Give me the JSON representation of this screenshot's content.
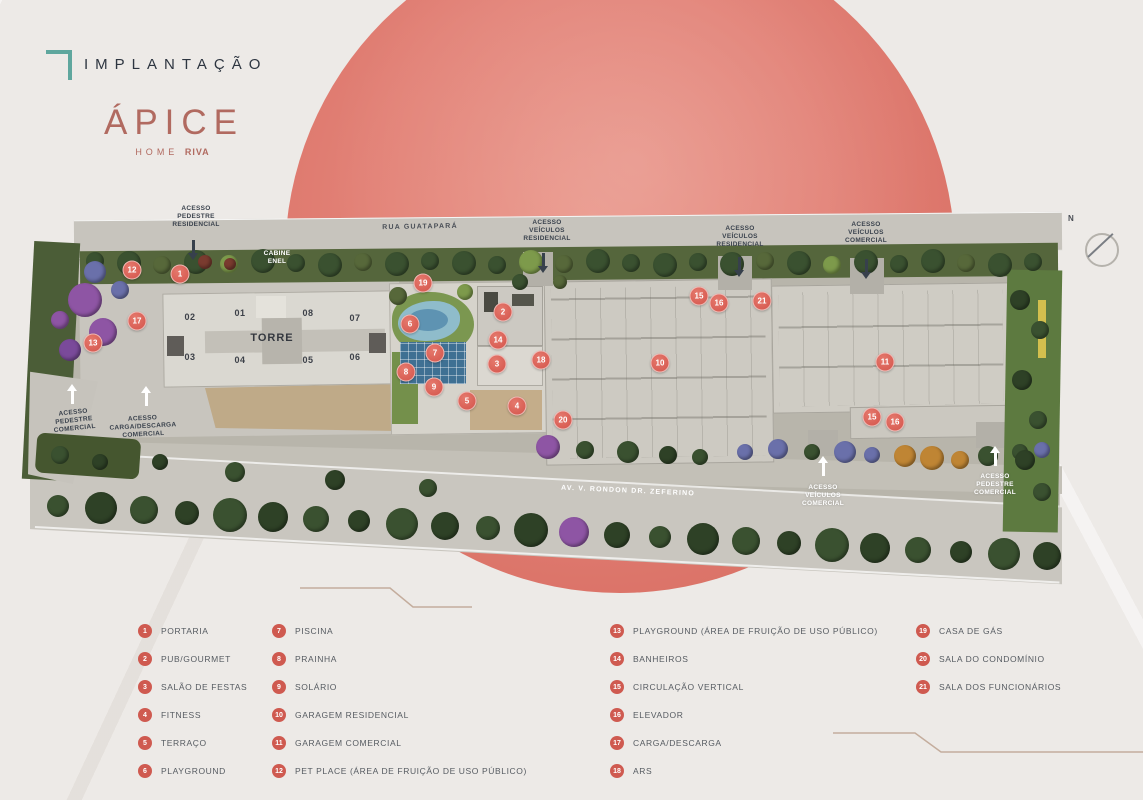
{
  "brand": {
    "section_label": "IMPLANTAÇÃO",
    "logo_primary": "ÁPICE",
    "logo_secondary": "HOME",
    "logo_brand": "RIVA",
    "accent_teal": "#5fa79e",
    "accent_rose": "#b16a60",
    "circle_color": "#e08176"
  },
  "plan": {
    "compass_label": "N",
    "marker_color": "#d95f55",
    "streets": [
      {
        "name": "RUA GUATAPARÁ",
        "x": 420,
        "y": 227,
        "tone": "dark",
        "rot": -1
      },
      {
        "name": "AV. V. RONDON DR. ZEFERINO",
        "x": 628,
        "y": 491,
        "tone": "white",
        "rot": 2.5
      }
    ],
    "access_labels": [
      {
        "text": "ACESSO\nPEDESTRE\nRESIDENCIAL",
        "x": 196,
        "y": 217,
        "tone": "dark"
      },
      {
        "text": "ACESSO\nVEÍCULOS\nRESIDENCIAL",
        "x": 547,
        "y": 231,
        "tone": "dark"
      },
      {
        "text": "ACESSO\nVEÍCULOS\nRESIDENCIAL",
        "x": 740,
        "y": 237,
        "tone": "dark"
      },
      {
        "text": "ACESSO\nVEÍCULOS\nCOMERCIAL",
        "x": 866,
        "y": 233,
        "tone": "dark"
      },
      {
        "text": "CABINE\nENEL",
        "x": 277,
        "y": 258,
        "tone": "white"
      },
      {
        "text": "ACESSO\nPEDESTRE\nCOMERCIAL",
        "x": 74,
        "y": 421,
        "tone": "dark",
        "rot": -6
      },
      {
        "text": "ACESSO\nCARGA/DESCARGA\nCOMERCIAL",
        "x": 143,
        "y": 427,
        "tone": "dark",
        "rot": -3
      },
      {
        "text": "ACESSO\nVEÍCULOS\nCOMERCIAL",
        "x": 823,
        "y": 496,
        "tone": "white"
      },
      {
        "text": "ACESSO\nPEDESTRE\nCOMERCIAL",
        "x": 995,
        "y": 485,
        "tone": "white"
      }
    ],
    "arrows": [
      {
        "dir": "down",
        "tone": "dark",
        "x": 193,
        "y": 250
      },
      {
        "dir": "down",
        "tone": "dark",
        "x": 543,
        "y": 263
      },
      {
        "dir": "down",
        "tone": "dark",
        "x": 739,
        "y": 267
      },
      {
        "dir": "down",
        "tone": "dark",
        "x": 866,
        "y": 269
      },
      {
        "dir": "up",
        "tone": "white",
        "x": 72,
        "y": 394
      },
      {
        "dir": "up",
        "tone": "white",
        "x": 146,
        "y": 396
      },
      {
        "dir": "up",
        "tone": "white",
        "x": 823,
        "y": 466
      },
      {
        "dir": "up",
        "tone": "white",
        "x": 995,
        "y": 456
      }
    ],
    "tower": {
      "label": "TORRE",
      "units": [
        {
          "label": "02",
          "x": 190,
          "y": 317
        },
        {
          "label": "01",
          "x": 240,
          "y": 313
        },
        {
          "label": "08",
          "x": 308,
          "y": 313
        },
        {
          "label": "07",
          "x": 355,
          "y": 318
        },
        {
          "label": "03",
          "x": 190,
          "y": 357
        },
        {
          "label": "04",
          "x": 240,
          "y": 360
        },
        {
          "label": "05",
          "x": 308,
          "y": 360
        },
        {
          "label": "06",
          "x": 355,
          "y": 357
        }
      ]
    },
    "markers": [
      {
        "n": "12",
        "x": 132,
        "y": 270
      },
      {
        "n": "1",
        "x": 180,
        "y": 274
      },
      {
        "n": "19",
        "x": 423,
        "y": 283
      },
      {
        "n": "17",
        "x": 137,
        "y": 321
      },
      {
        "n": "13",
        "x": 93,
        "y": 343
      },
      {
        "n": "6",
        "x": 410,
        "y": 324
      },
      {
        "n": "2",
        "x": 503,
        "y": 312
      },
      {
        "n": "14",
        "x": 498,
        "y": 340
      },
      {
        "n": "7",
        "x": 435,
        "y": 353
      },
      {
        "n": "3",
        "x": 497,
        "y": 364
      },
      {
        "n": "18",
        "x": 541,
        "y": 360
      },
      {
        "n": "8",
        "x": 406,
        "y": 372
      },
      {
        "n": "9",
        "x": 434,
        "y": 387
      },
      {
        "n": "5",
        "x": 467,
        "y": 401
      },
      {
        "n": "4",
        "x": 517,
        "y": 406
      },
      {
        "n": "20",
        "x": 563,
        "y": 420
      },
      {
        "n": "10",
        "x": 660,
        "y": 363
      },
      {
        "n": "15",
        "x": 699,
        "y": 296
      },
      {
        "n": "16",
        "x": 719,
        "y": 303
      },
      {
        "n": "21",
        "x": 762,
        "y": 301
      },
      {
        "n": "11",
        "x": 885,
        "y": 362
      },
      {
        "n": "15",
        "x": 872,
        "y": 417
      },
      {
        "n": "16",
        "x": 895,
        "y": 422
      }
    ]
  },
  "legend": {
    "badge_color": "#cf5a50",
    "col1": [
      {
        "n": "1",
        "label": "PORTARIA"
      },
      {
        "n": "2",
        "label": "PUB/GOURMET"
      },
      {
        "n": "3",
        "label": "SALÃO DE FESTAS"
      },
      {
        "n": "4",
        "label": "FITNESS"
      },
      {
        "n": "5",
        "label": "TERRAÇO"
      },
      {
        "n": "6",
        "label": "PLAYGROUND"
      }
    ],
    "col2": [
      {
        "n": "7",
        "label": "PISCINA"
      },
      {
        "n": "8",
        "label": "PRAINHA"
      },
      {
        "n": "9",
        "label": "SOLÁRIO"
      },
      {
        "n": "10",
        "label": "GARAGEM RESIDENCIAL"
      },
      {
        "n": "11",
        "label": "GARAGEM COMERCIAL"
      },
      {
        "n": "12",
        "label": "PET PLACE (ÁREA DE FRUIÇÃO DE USO PÚBLICO)"
      }
    ],
    "col3": [
      {
        "n": "13",
        "label": "PLAYGROUND (ÁREA DE FRUIÇÃO DE USO PÚBLICO)"
      },
      {
        "n": "14",
        "label": "BANHEIROS"
      },
      {
        "n": "15",
        "label": "CIRCULAÇÃO VERTICAL"
      },
      {
        "n": "16",
        "label": "ELEVADOR"
      },
      {
        "n": "17",
        "label": "CARGA/DESCARGA"
      },
      {
        "n": "18",
        "label": "ARS"
      }
    ],
    "col4": [
      {
        "n": "19",
        "label": "CASA DE GÁS"
      },
      {
        "n": "20",
        "label": "SALA DO CONDOMÍNIO"
      },
      {
        "n": "21",
        "label": "SALA DOS FUNCIONÁRIOS"
      }
    ]
  }
}
